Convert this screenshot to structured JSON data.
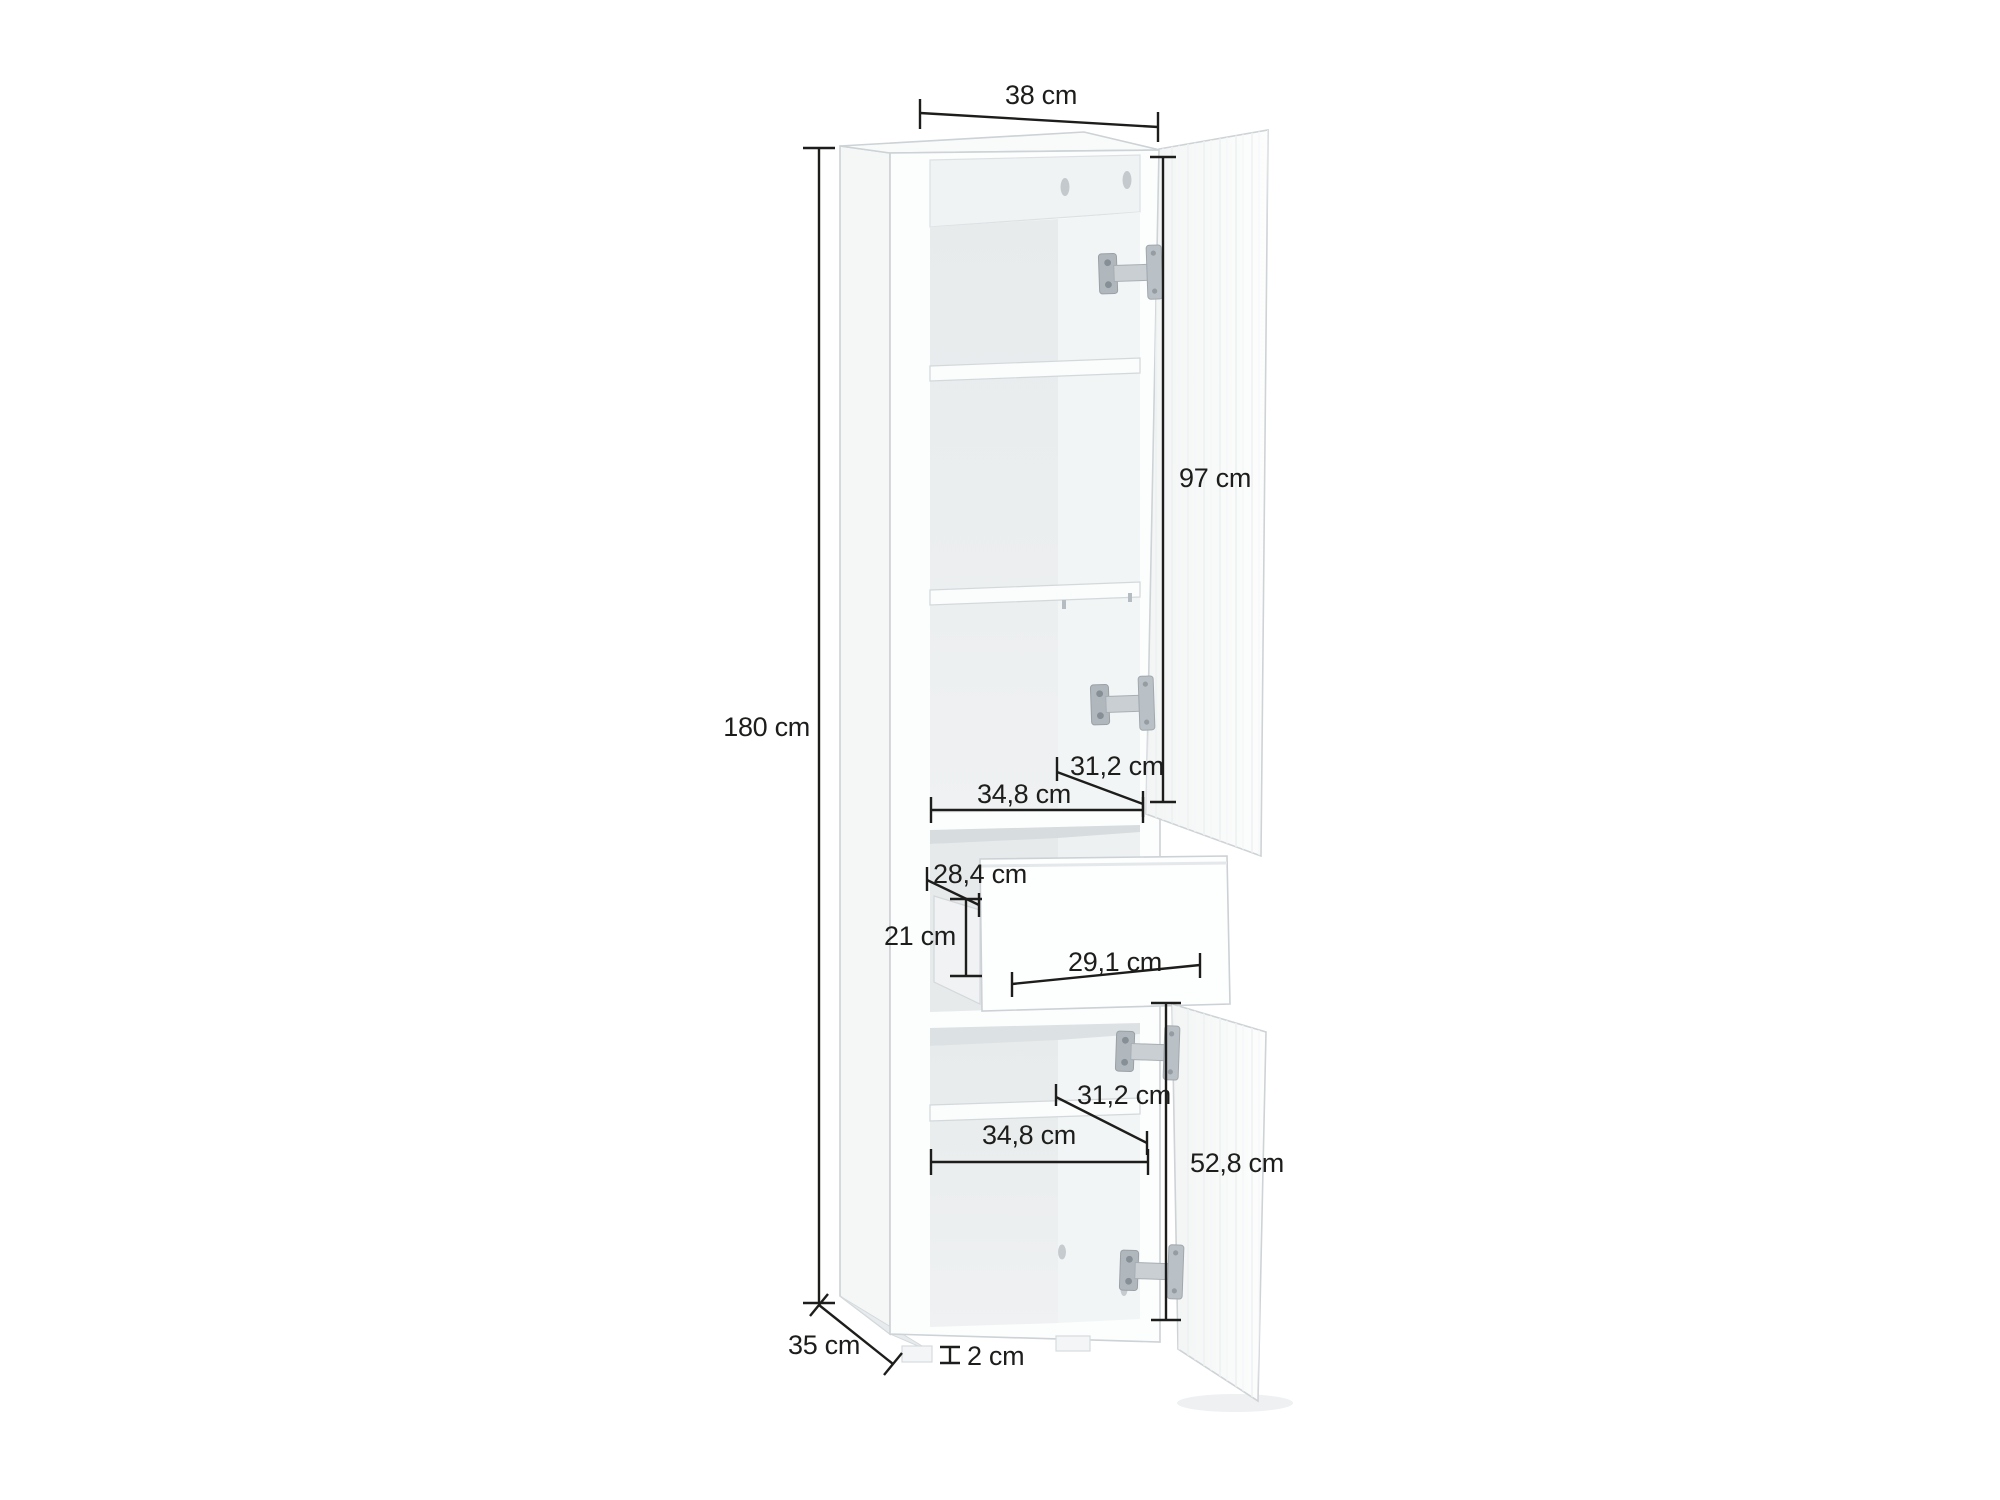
{
  "figure": {
    "type": "furniture-dimension-diagram",
    "subject": "tall cabinet with two open doors and open drawer",
    "background_color": "#ffffff",
    "dimension_line_color": "#1d1d1b",
    "cabinet_fill_color": "#fbfcfd",
    "labels": {
      "overall_width": "38 cm",
      "overall_height": "180 cm",
      "upper_door_height": "97 cm",
      "upper_interior_depth": "31,2 cm",
      "upper_interior_width": "34,8 cm",
      "drawer_interior_width": "28,4 cm",
      "drawer_interior_height": "21 cm",
      "drawer_front_width": "29,1 cm",
      "lower_interior_depth": "31,2 cm",
      "lower_interior_width": "34,8 cm",
      "lower_door_height": "52,8 cm",
      "overall_depth": "35 cm",
      "plinth_height": "2 cm"
    }
  }
}
